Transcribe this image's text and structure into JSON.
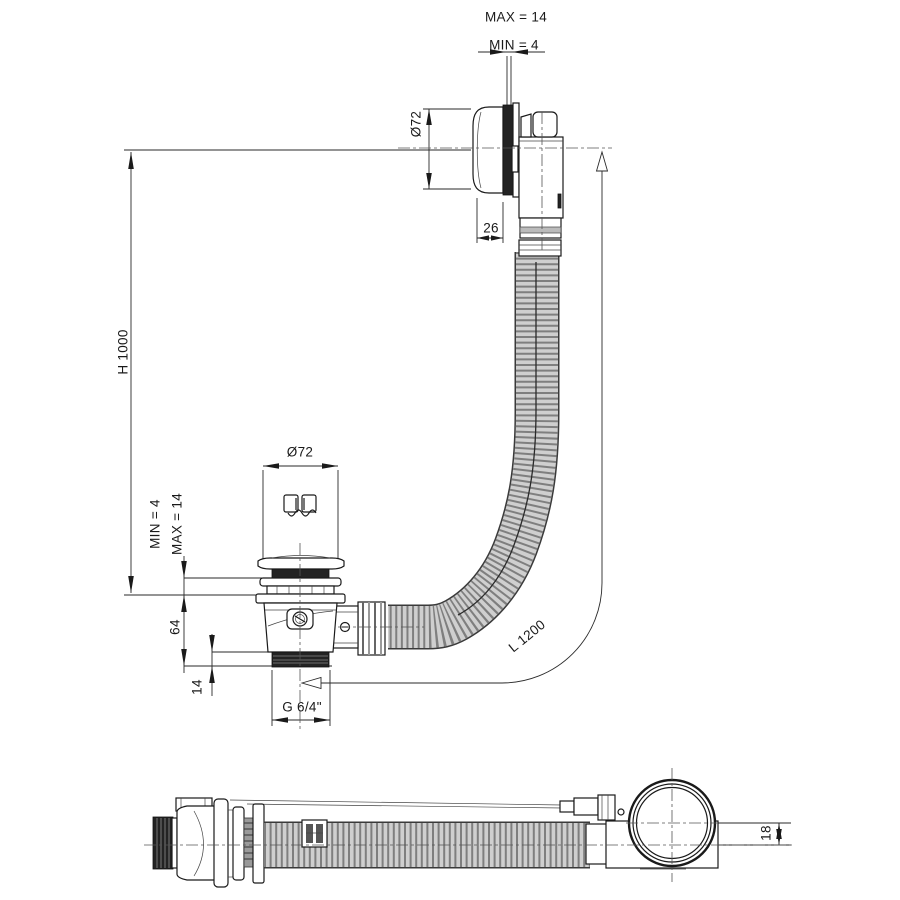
{
  "drawing": {
    "description": "bath waste and overflow set technical drawing",
    "labels": {
      "max_panel_top": "MAX = 14",
      "min_panel_top": "MIN = 4",
      "knob_diameter": "Ø72",
      "knob_depth": "26",
      "height": "H 1000",
      "plug_diameter": "Ø72",
      "min_panel_drain": "MIN = 4",
      "max_panel_drain": "MAX = 14",
      "body_height": "64",
      "thread_length": "14",
      "thread_size": "G 6/4\"",
      "hose_length": "L 1200",
      "axis_offset": "18"
    },
    "colors": {
      "line": "#1a1a1a",
      "hose_fill": "#cfcfcf",
      "hose_rib": "#7f7f7f",
      "dark_part": "#232323",
      "background": "#ffffff"
    }
  }
}
